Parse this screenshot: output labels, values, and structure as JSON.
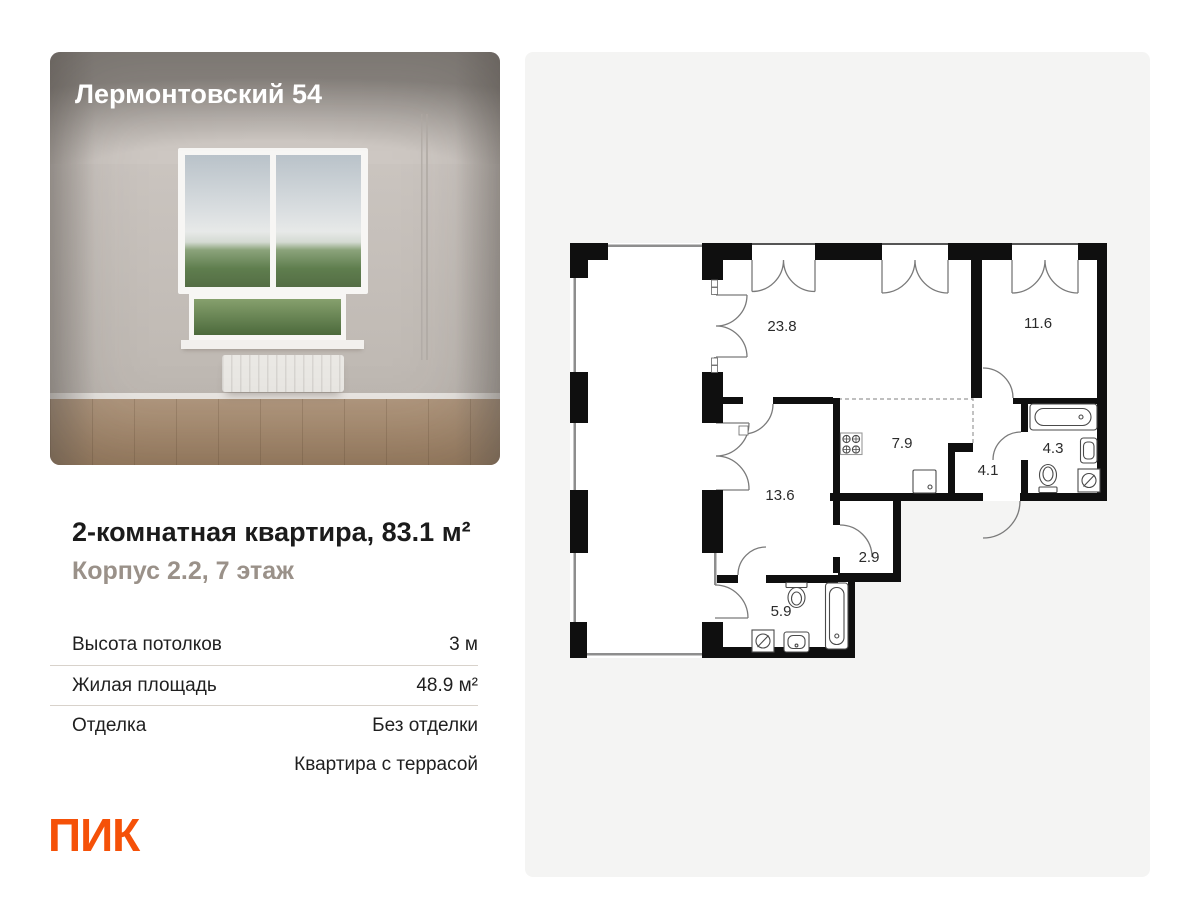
{
  "project": {
    "name": "Лермонтовский 54"
  },
  "listing": {
    "title": "2-комнатная квартира, 83.1 м²",
    "subtitle": "Корпус 2.2, 7 этаж",
    "specs": [
      {
        "label": "Высота потолков",
        "value": "3 м"
      },
      {
        "label": "Жилая площадь",
        "value": "48.9 м²"
      },
      {
        "label": "Отделка",
        "value": "Без отделки"
      },
      {
        "label": "",
        "value": "Квартира с террасой"
      }
    ]
  },
  "brand": {
    "logo": "ПИК",
    "color": "#F55108"
  },
  "floorplan": {
    "rooms": [
      {
        "name": "living-room",
        "area": "23.8"
      },
      {
        "name": "bedroom",
        "area": "11.6"
      },
      {
        "name": "kitchen",
        "area": "7.9"
      },
      {
        "name": "hallway",
        "area": "4.1"
      },
      {
        "name": "bathroom",
        "area": "4.3"
      },
      {
        "name": "bedroom-2",
        "area": "13.6"
      },
      {
        "name": "wardrobe",
        "area": "2.9"
      },
      {
        "name": "bathroom-2",
        "area": "5.9"
      }
    ]
  }
}
